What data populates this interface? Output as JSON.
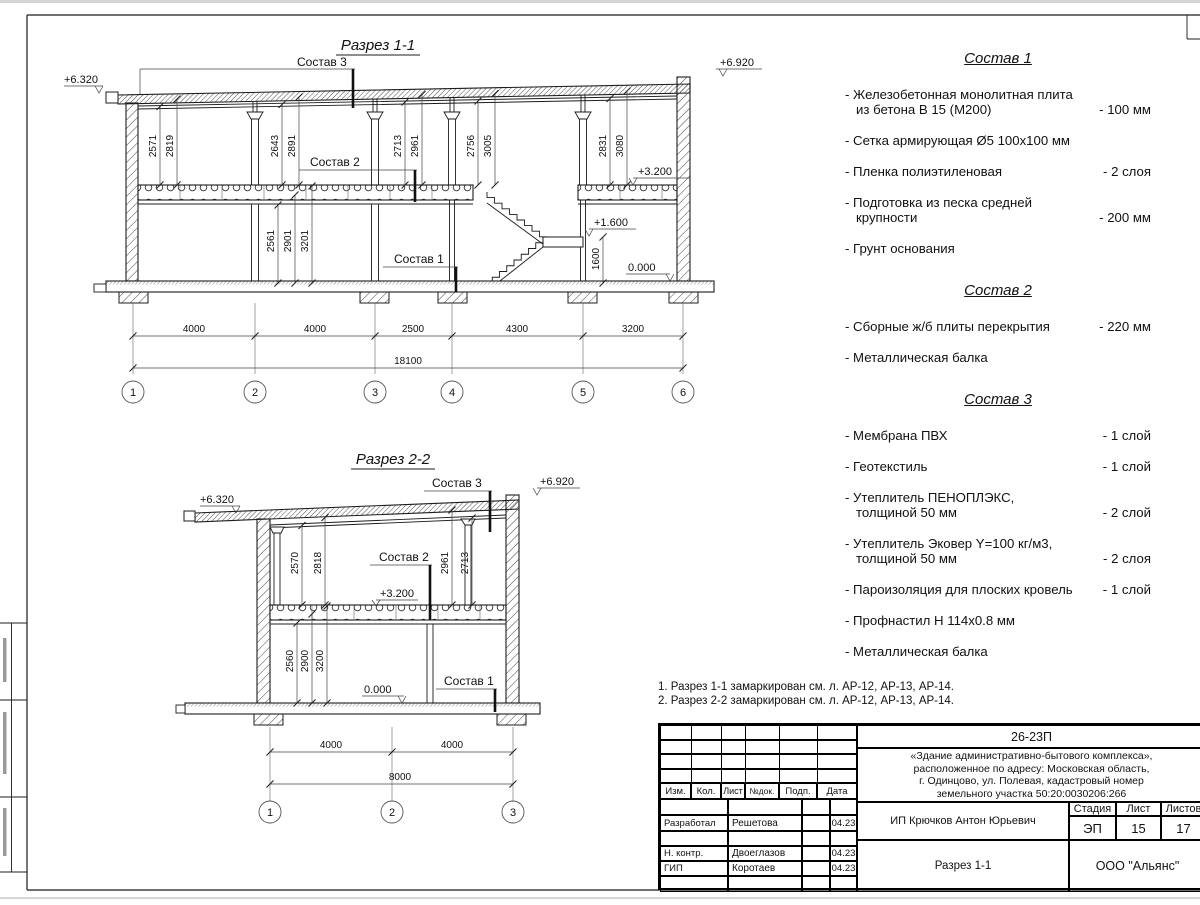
{
  "sections": {
    "labels": {
      "s1": "Состав 1",
      "s2": "Состав 2",
      "s3": "Состав 3"
    },
    "s1": {
      "title": "Разрез 1-1",
      "elev": {
        "left": "+6.320",
        "right": "+6.920",
        "floor": "+3.200",
        "landing": "+1.600",
        "ground": "0.000"
      },
      "landing_dim": "1600",
      "upper_dims": [
        "2571",
        "2819",
        "2643",
        "2891",
        "2713",
        "2961",
        "2756",
        "3005",
        "2831",
        "3080"
      ],
      "lower_dims": [
        "2561",
        "2901",
        "3201"
      ],
      "span_dims": [
        "4000",
        "4000",
        "2500",
        "4300",
        "3200"
      ],
      "total_dim": "18100",
      "axes": [
        "1",
        "2",
        "3",
        "4",
        "5",
        "6"
      ]
    },
    "s2": {
      "title": "Разрез 2-2",
      "elev": {
        "left": "+6.320",
        "right": "+6.920",
        "floor": "+3.200",
        "ground": "0.000"
      },
      "upper_dims": [
        "2570",
        "2818",
        "2961",
        "2713"
      ],
      "lower_dims": [
        "2560",
        "2900",
        "3200"
      ],
      "span_dims": [
        "4000",
        "4000"
      ],
      "total_dim": "8000",
      "axes": [
        "1",
        "2",
        "3"
      ]
    }
  },
  "specs": [
    {
      "title": "Состав 1",
      "items": [
        {
          "name": "- Железобетонная  монолитная плита\nиз бетона В 15 (М200)",
          "value": "- 100 мм"
        },
        {
          "name": "- Сетка армирующая Ø5 100х100 мм",
          "value": ""
        },
        {
          "name": "- Пленка полиэтиленовая",
          "value": "-  2 слоя"
        },
        {
          "name": "- Подготовка из песка средней\nкрупности",
          "value": "- 200 мм"
        },
        {
          "name": "- Грунт основания",
          "value": ""
        }
      ]
    },
    {
      "title": "Состав 2",
      "items": [
        {
          "name": "- Сборные ж/б плиты перекрытия",
          "value": "- 220 мм"
        },
        {
          "name": "- Металлическая балка",
          "value": ""
        }
      ]
    },
    {
      "title": "Состав 3",
      "items": [
        {
          "name": "- Мембрана ПВХ",
          "value": "- 1 слой"
        },
        {
          "name": "- Геотекстиль",
          "value": "- 1 слой"
        },
        {
          "name": "- Утеплитель ПЕНОПЛЭКС,\nтолщиной 50 мм",
          "value": "- 2 слой"
        },
        {
          "name": "- Утеплитель Эковер Y=100 кг/м3,\nтолщиной 50 мм",
          "value": "- 2 слоя"
        },
        {
          "name": "- Пароизоляция для плоских кровель",
          "value": "- 1 слой"
        },
        {
          "name": "- Профнастил Н 114х0.8 мм",
          "value": ""
        },
        {
          "name": "- Металлическая балка",
          "value": ""
        }
      ]
    }
  ],
  "notes": [
    "1. Разрез 1-1 замаркирован см. л. АР-12, АР-13, АР-14.",
    "2. Разрез 2-2 замаркирован см. л. АР-12, АР-13, АР-14."
  ],
  "titleblock": {
    "doc_number": "26-23П",
    "project": "«Здание административно-бытового комплекса»,\nрасположенное по адресу: Московская область,\nг. Одинцово, ул. Полевая, кадастровый номер\nземельного участка 50:20:0030206:266",
    "header_cols": [
      "Изм.",
      "Кол.",
      "Лист",
      "№док.",
      "Подп.",
      "Дата"
    ],
    "rows": [
      {
        "role": "Разработал",
        "name": "Решетова",
        "date": "04.23"
      },
      {
        "role": "Н. контр.",
        "name": "Двоеглазов",
        "date": "04.23"
      },
      {
        "role": "ГИП",
        "name": "Коротаев",
        "date": "04.23"
      }
    ],
    "client": "ИП Крючков Антон Юрьевич",
    "stage_label": "Стадия",
    "sheet_label": "Лист",
    "sheets_label": "Листов",
    "stage": "ЭП",
    "sheet": "15",
    "sheets": "17",
    "sheet_title": "Разрез 1-1",
    "company": "ООО \"Альянс\""
  }
}
